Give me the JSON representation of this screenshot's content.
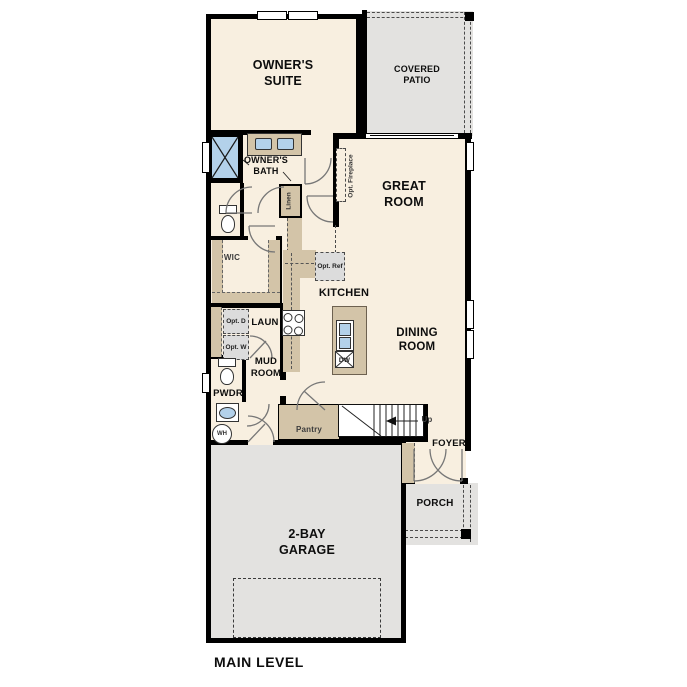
{
  "title": "MAIN LEVEL",
  "rooms": {
    "owners_suite": "OWNER'S SUITE",
    "covered_patio": "COVERED PATIO",
    "owners_bath": "OWNER'S BATH",
    "great_room": "GREAT ROOM",
    "wic": "WIC",
    "kitchen": "KITCHEN",
    "laundry": "LAUN",
    "mud_room": "MUD ROOM",
    "powder": "PWDR",
    "dining_room": "DINING ROOM",
    "foyer": "FOYER",
    "porch": "PORCH",
    "garage": "2-BAY GARAGE"
  },
  "fixtures": {
    "opt_fireplace": "Opt. Fireplace",
    "linen": "Linen",
    "opt_ref": "Opt. Ref",
    "opt_dryer": "Opt. D",
    "opt_washer": "Opt. W",
    "water_heater": "WH",
    "dishwasher": "DW",
    "pantry": "Pantry",
    "stairs_up": "Up"
  },
  "colors": {
    "floor": "#f8efe0",
    "outdoor": "#e3e2e0",
    "cabinet": "#d3c4a8",
    "fixture_blue": "#b3d1ea",
    "wall": "#000000"
  }
}
